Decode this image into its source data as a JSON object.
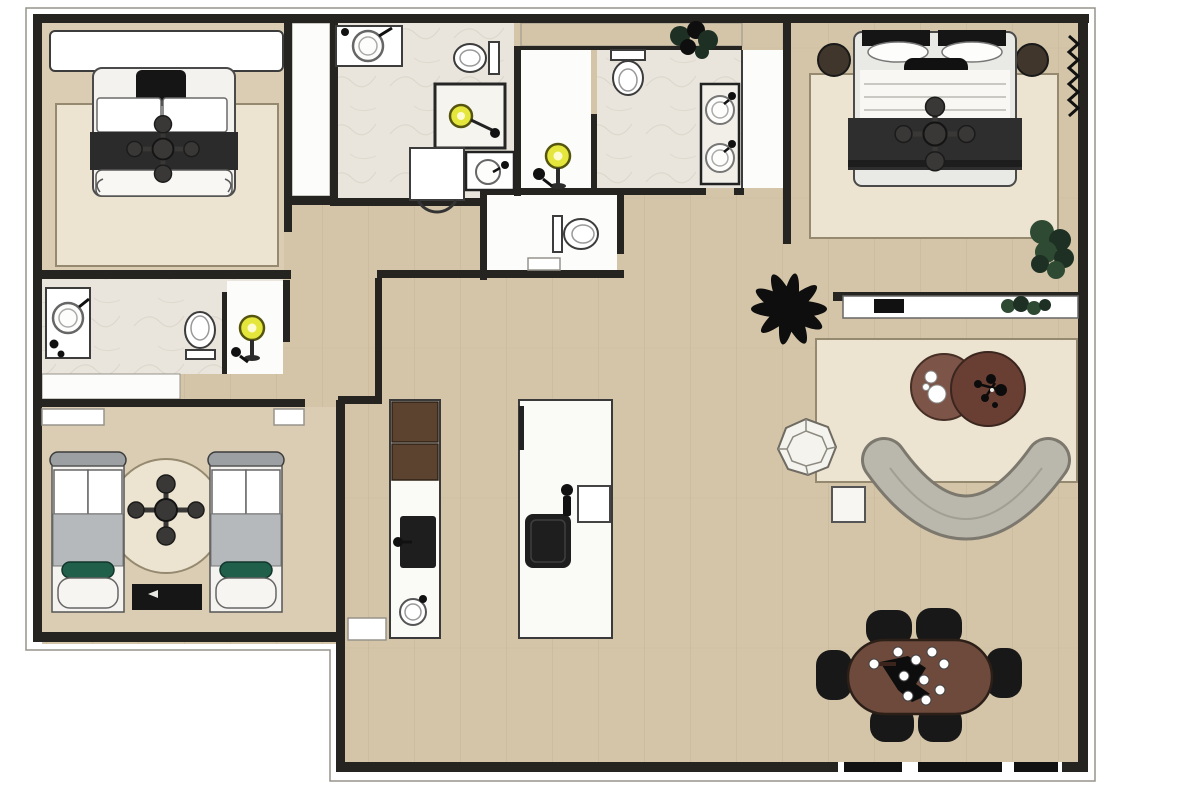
{
  "title": "3D rendered apartment floor plan (top view, no text labels)",
  "colors": {
    "outside": "#ffffff",
    "wall": "#262420",
    "outline_thin": "#97948c",
    "wood": "#d4c5a9",
    "wood_plank": "#c0ae90",
    "wood_light": "#dacdb4",
    "marble": "#e9e5dc",
    "marble_vein": "#d6d0c3",
    "white_floor": "#fcfcfa",
    "fixture_white": "#ffffff",
    "fixture_stroke": "#3c3c3c",
    "rug": "#ece4d0",
    "rug_border": "#95896f",
    "bed_white": "#f3f2ee",
    "duvet_white": "#f8f7f4",
    "blanket_dark": "#2b2b2b",
    "headboard_black": "#151515",
    "master_frame": "#e9e9e5",
    "kids_blanket": "#b5b9bb",
    "kids_pillow_green": "#20604b",
    "kids_headboard": "#9da0a3",
    "bench_black": "#161616",
    "nightstand_brown": "#40362c",
    "sofa_gray": "#bab7ad",
    "sofa_outline": "#7c786e",
    "chair_facet": "#f4f3ee",
    "side_table": "#f7f6f3",
    "coffee_table_light": "#7d5448",
    "coffee_table_dark": "#693f33",
    "dining_table": "#6d4a3c",
    "chair_black": "#181818",
    "cabinet_walnut": "#5c4330",
    "appliance_black": "#1e1e1e",
    "island_white": "#fafaf7",
    "shower_yellow": "#e5e63c",
    "shower_yellow_rim": "#55550f",
    "plant_black": "#0e0e0e",
    "plant_green": "#2e4a33",
    "plant_green_dark": "#1d3023",
    "fan_gray": "#3a3836",
    "window_black": "#111111"
  },
  "rooms": [
    {
      "id": "bedroom-1",
      "fixtures": [
        "wardrobe",
        "double-bed",
        "ceiling-fan",
        "rug"
      ]
    },
    {
      "id": "bathroom-1",
      "fixtures": [
        "corner-sink",
        "toilet",
        "shower-enclosure",
        "washing-machine",
        "vanity-sink"
      ]
    },
    {
      "id": "master-bathroom",
      "fixtures": [
        "walk-in-shower",
        "toilet",
        "double-vanity",
        "plant",
        "closet-strip"
      ]
    },
    {
      "id": "toilet-room",
      "fixtures": [
        "toilet",
        "shelf"
      ]
    },
    {
      "id": "master-bedroom",
      "fixtures": [
        "double-bed",
        "ceiling-fan",
        "nightstand-left",
        "nightstand-right",
        "rug",
        "curtain",
        "corner-plant"
      ]
    },
    {
      "id": "living-room",
      "fixtures": [
        "palm-plant",
        "tv-console",
        "tv",
        "console-plant",
        "rug",
        "coffee-table-pair",
        "curved-sofa",
        "faceted-armchair",
        "side-table"
      ]
    },
    {
      "id": "dining-area",
      "fixtures": [
        "oval-dining-table",
        "dining-chairs-x6",
        "chandelier",
        "window-wall"
      ]
    },
    {
      "id": "kitchen",
      "fixtures": [
        "tall-cabinet",
        "counter-run",
        "black-sink-unit",
        "round-sink",
        "island",
        "cooktop",
        "island-faucet",
        "island-sink",
        "service-box"
      ]
    },
    {
      "id": "kids-bedroom",
      "fixtures": [
        "twin-bed-left",
        "twin-bed-right",
        "round-rug",
        "ceiling-fan",
        "media-bench",
        "wardrobe-left",
        "wardrobe-right"
      ]
    },
    {
      "id": "kids-bathroom",
      "fixtures": [
        "sink",
        "toilet",
        "shower",
        "closet"
      ]
    },
    {
      "id": "hallway",
      "fixtures": []
    }
  ]
}
